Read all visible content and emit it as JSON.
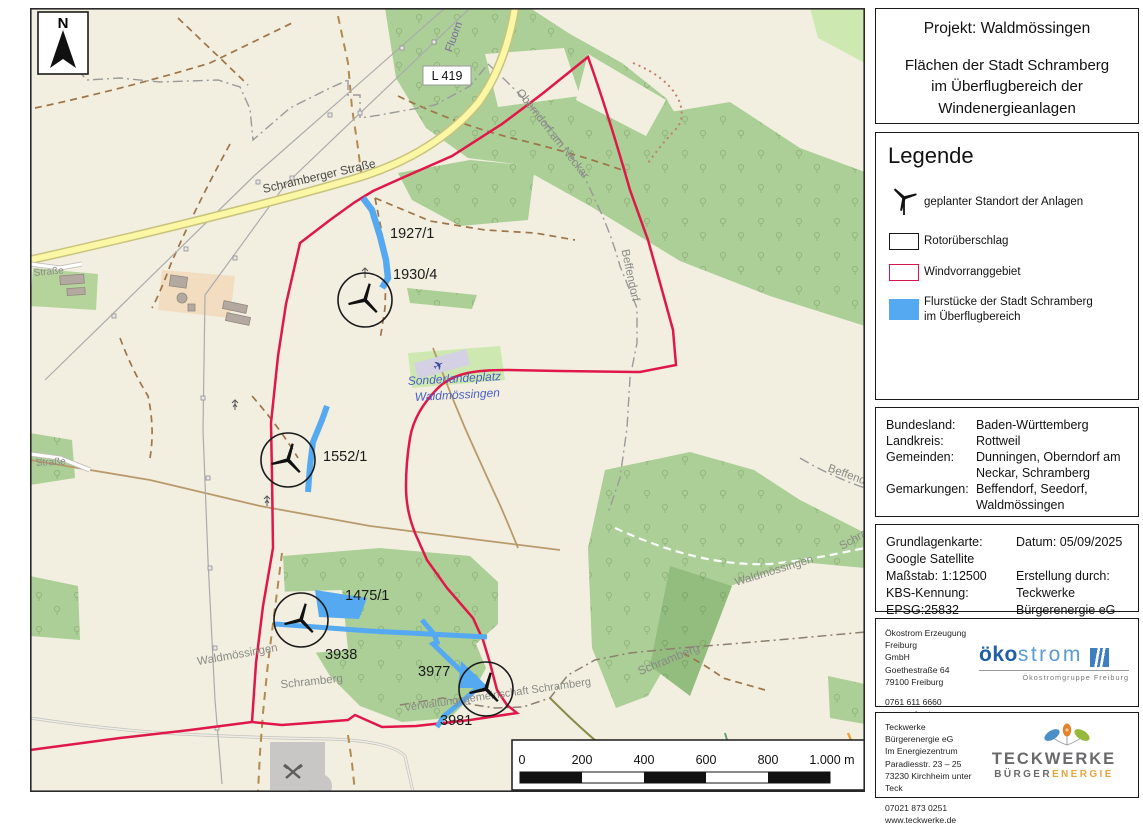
{
  "colors": {
    "boundary_red": "#e0184a",
    "parcel_blue": "#55a9f0",
    "forest_green": "#abcf96",
    "road_yellow": "#fbf7a5",
    "okostrom_blue": "#1f5fa8",
    "teckwerke_orange": "#e8a33d"
  },
  "map": {
    "north_label": "N",
    "road_badge": "L 419",
    "labels": {
      "schramberger_strasse": "Schramberger Straße",
      "fluorn": "Fluorn",
      "oberndorf": "Oberndorf am Neckar",
      "beffendorf_upper": "Beffendorf",
      "beffendorf_right": "Beffendorf",
      "waldmossingen_road": "Waldmössingen",
      "schramberg_road_right": "Schramberg",
      "schramberg_right": "Schramberg",
      "waldmossingen_left": "Waldmössingen",
      "schramberg_left": "Schramberg",
      "verwaltung": "Verwaltungsgemeinschaft Schramberg",
      "strasse_upper": "Straße",
      "strasse_lower": "Straße",
      "airfield_line1": "Sonderlandeplatz",
      "airfield_line2": "Waldmössingen"
    },
    "parcels": {
      "p1927": "1927/1",
      "p1930": "1930/4",
      "p1552": "1552/1",
      "p1475": "1475/1",
      "p3938": "3938",
      "p3977": "3977",
      "p3981": "3981"
    },
    "scalebar": {
      "t0": "0",
      "t200": "200",
      "t400": "400",
      "t600": "600",
      "t800": "800",
      "t1000": "1.000 m"
    }
  },
  "panel": {
    "title": {
      "project": "Projekt: Waldmössingen",
      "subtitle_line1": "Flächen der Stadt Schramberg",
      "subtitle_line2": "im Überflugbereich der",
      "subtitle_line3": "Windenergieanlagen"
    },
    "legend": {
      "heading": "Legende",
      "items": [
        {
          "label": "geplanter Standort der Anlagen"
        },
        {
          "label": "Rotorüberschlag"
        },
        {
          "label": "Windvorranggebiet"
        },
        {
          "label": "Flurstücke der Stadt Schramberg im Überflugbereich"
        }
      ]
    },
    "admin": {
      "rows": [
        {
          "label": "Bundesland:",
          "value": "Baden-Württemberg"
        },
        {
          "label": "Landkreis:",
          "value": "Rottweil"
        },
        {
          "label": "Gemeinden:",
          "value": "Dunningen, Oberndorf am Neckar, Schramberg"
        },
        {
          "label": "Gemarkungen:",
          "value": "Beffendorf, Seedorf, Waldmössingen"
        }
      ]
    },
    "basis": {
      "left": [
        "Grundlagenkarte:",
        "Google Satellite",
        "Maßstab: 1:12500",
        "KBS-Kennung:",
        "EPSG:25832"
      ],
      "right": [
        "Datum: 05/09/2025",
        "",
        "Erstellung durch:",
        "Teckwerke",
        "Bürgerenergie eG"
      ]
    },
    "okostrom": {
      "address": [
        "Ökostrom Erzeugung Freiburg",
        "GmbH",
        "Goethestraße 64",
        "79100 Freiburg"
      ],
      "phone": "0761 611 6660",
      "web": "www.oekostrom-freiburg.de",
      "logo_part1": "öko",
      "logo_part2": "strom",
      "logo_sub": "Ökostromgruppe Freiburg"
    },
    "teckwerke": {
      "address": [
        "Teckwerke Bürgerenergie eG",
        "Im Energiezentrum",
        "Paradiesstr. 23 – 25",
        "73230 Kirchheim unter Teck"
      ],
      "phone": "07021 873 0251",
      "web": "www.teckwerke.de",
      "logo_main": "TECKWERKE",
      "logo_sub1": "BÜRGER",
      "logo_sub2": "ENERGIE"
    }
  }
}
